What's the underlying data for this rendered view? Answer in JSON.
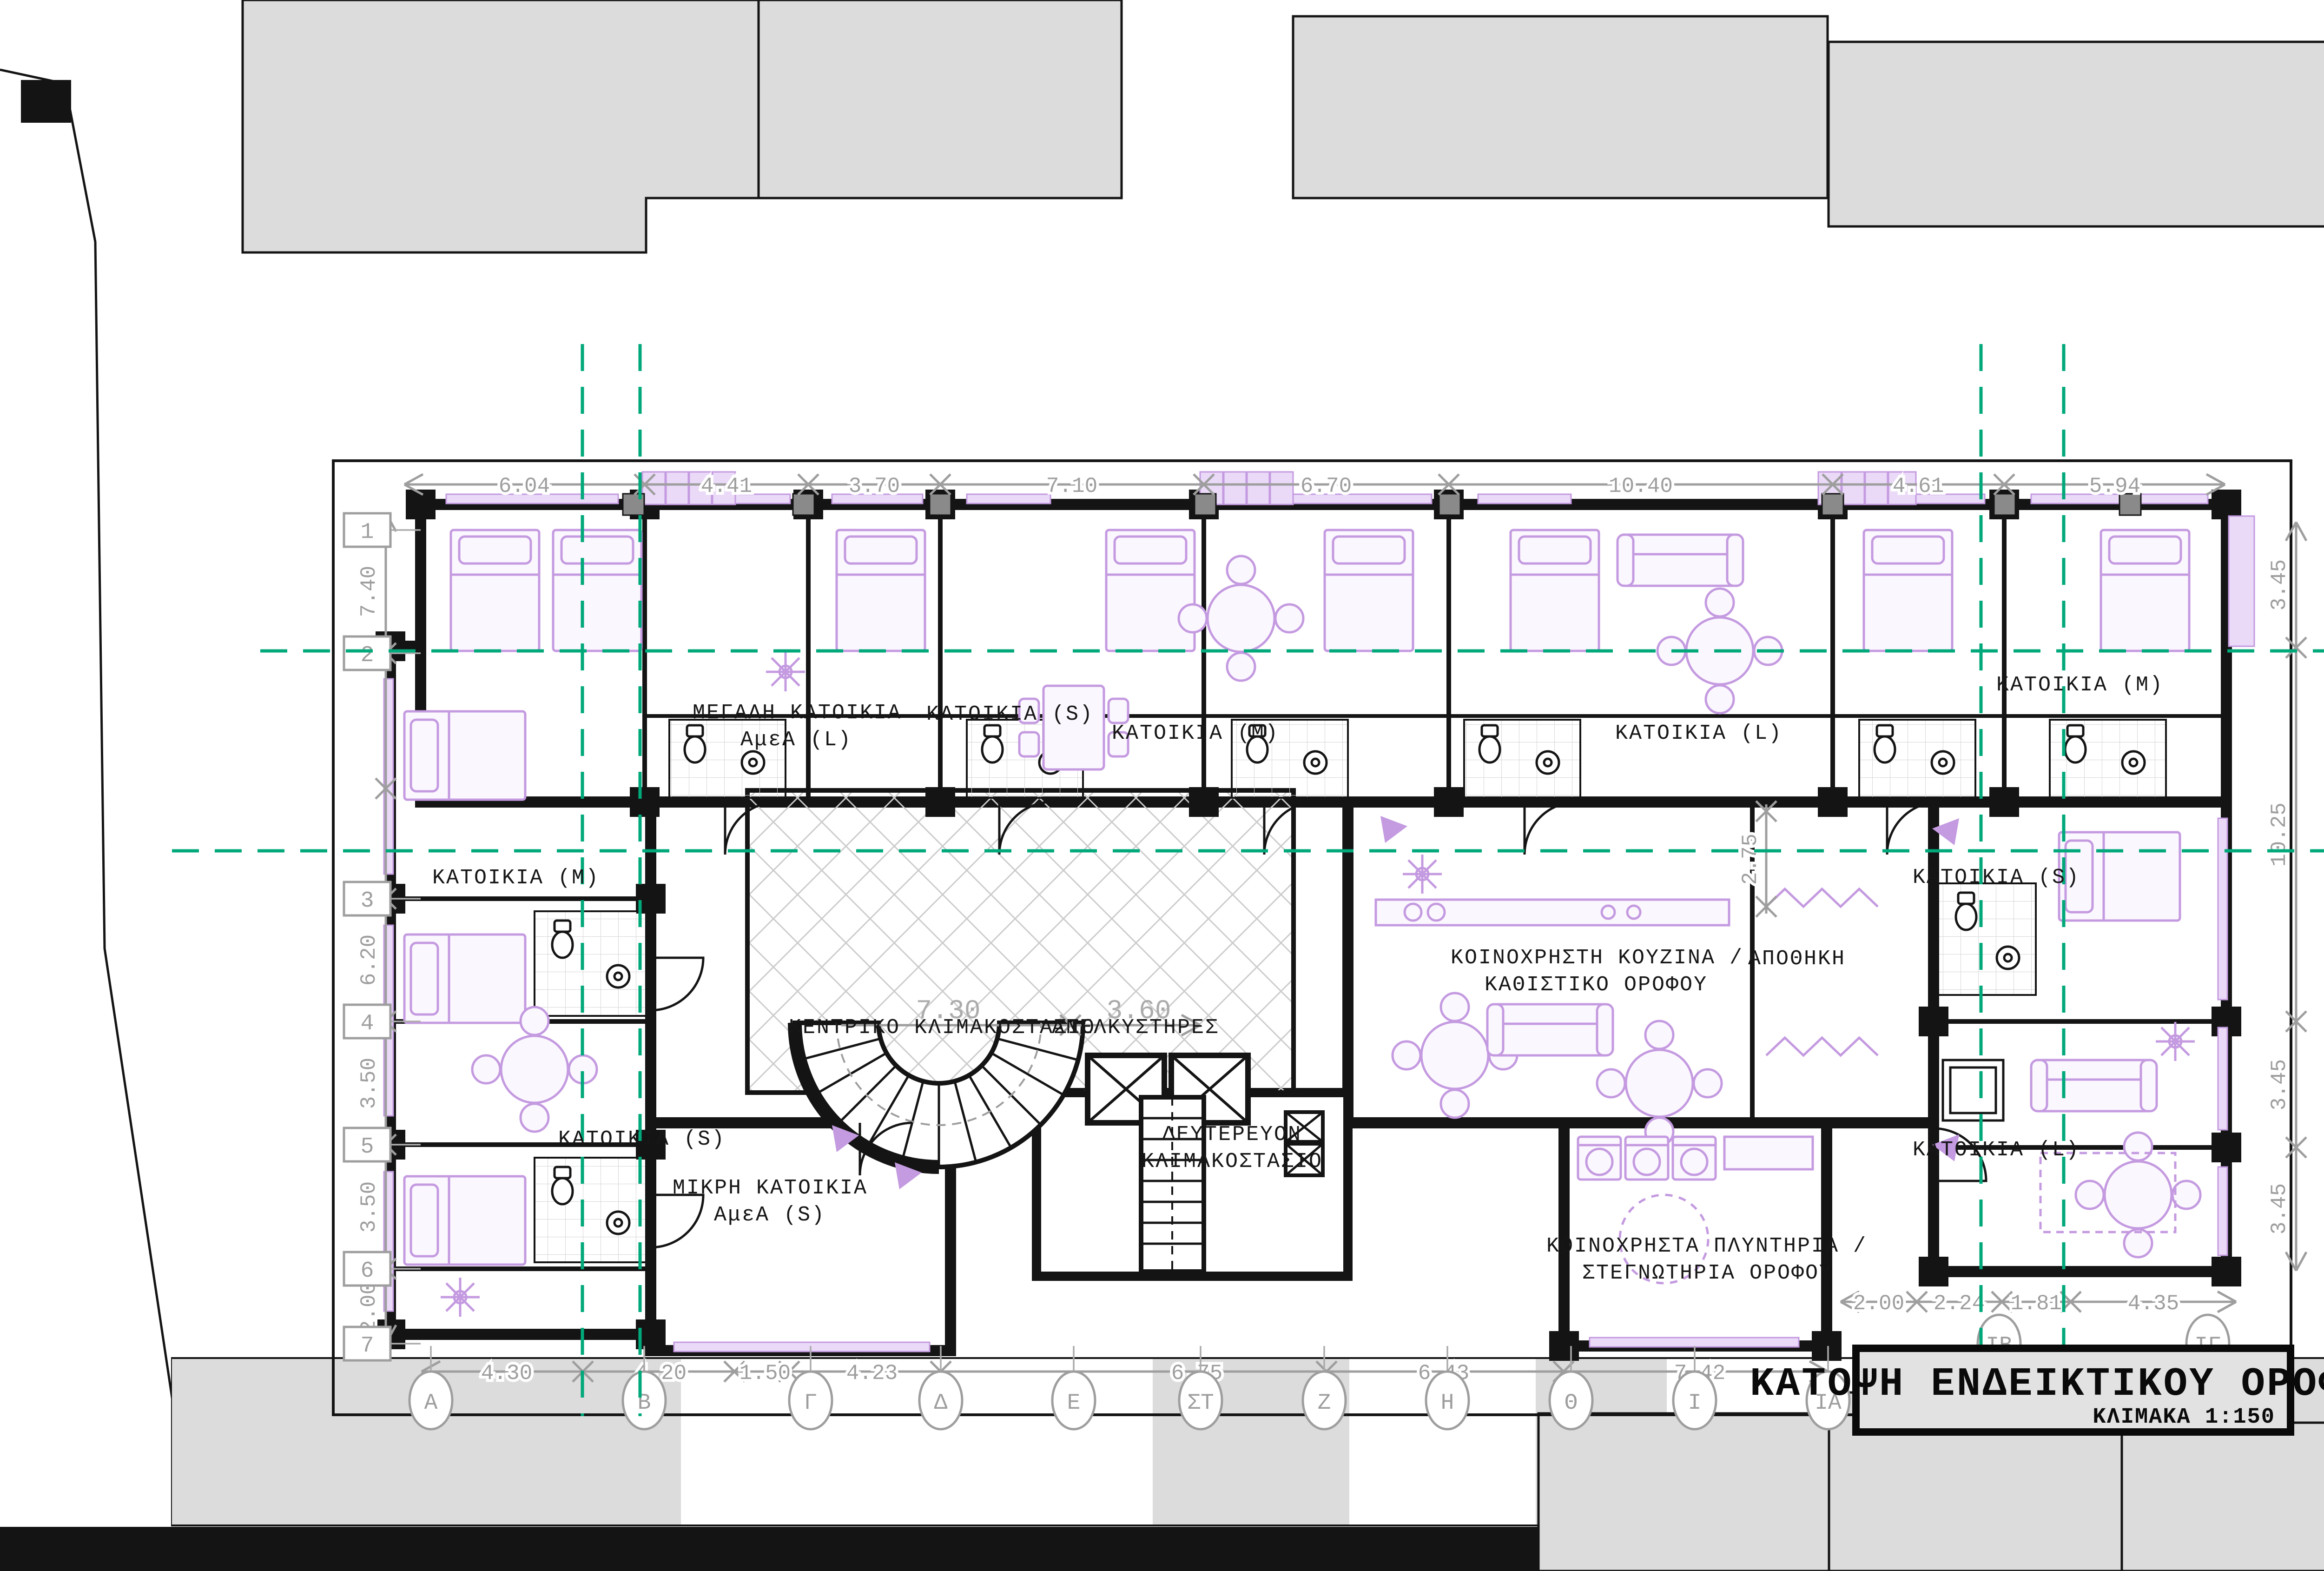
{
  "header": {
    "title": "ΚΑΤΟΨΗ ΕΝΔΕΙΚΤΙΚΟΥ ΟΡΟΦΟΥ",
    "scale": "ΚΛΙΜΑΚΑ 1:150"
  },
  "grid": {
    "rows": [
      "1",
      "2",
      "3",
      "4",
      "5",
      "6",
      "7"
    ],
    "cols": [
      "Α",
      "Β",
      "Γ",
      "Δ",
      "Ε",
      "ΣΤ",
      "Ζ",
      "Η",
      "Θ",
      "Ι",
      "ΙΑ"
    ],
    "cols_right": [
      "ΙΒ",
      "ΙΓ"
    ]
  },
  "dims": {
    "top": [
      "6.04",
      "4.41",
      "3.70",
      "7.10",
      "6.70",
      "10.40",
      "4.61",
      "5.94"
    ],
    "left": [
      "7.40",
      "6.20",
      "3.50",
      "3.50",
      "2.00"
    ],
    "right": [
      "3.45",
      "10.25",
      "3.45",
      "3.45"
    ],
    "bottom": [
      "4.30",
      "4.20",
      "1.50",
      "4.23",
      "6.75",
      "6.43",
      "7.42"
    ],
    "bottom_right": [
      "2.00",
      "2.24",
      "1.81",
      "4.35"
    ],
    "inner": [
      "7.30",
      "3.60",
      "2.75"
    ]
  },
  "rooms": {
    "large_unit_1": "ΜΕΓΑΛΗ ΚΑΤΟΙΚΙΑ",
    "large_unit_2": "ΑμεΑ (L)",
    "unit_s_top": "ΚΑΤΟΙΚΙΑ (S)",
    "unit_m_top": "ΚΑΤΟΙΚΙΑ (M)",
    "unit_l_top": "ΚΑΤΟΙΚΙΑ (L)",
    "unit_m_top_right": "ΚΑΤΟΙΚΙΑ (M)",
    "unit_m_left": "ΚΑΤΟΙΚΙΑ (M)",
    "unit_s_left": "ΚΑΤΟΙΚΙΑ (S)",
    "small_unit_1": "ΜΙΚΡΗ ΚΑΤΟΙΚΙΑ",
    "small_unit_2": "ΑμεΑ (S)",
    "unit_s_right": "ΚΑΤΟΙΚΙΑ (S)",
    "unit_l_right": "ΚΑΤΟΙΚΙΑ (L)",
    "main_stair": "ΚΕΝΤΡΙΚΟ ΚΛΙΜΑΚΟΣΤΑΣΙΟ",
    "elevators": "ΑΝΕΛΚΥΣΤΗΡΕΣ",
    "secondary_stair_1": "ΔΕΥΤΕΡΕΥΟΝ",
    "secondary_stair_2": "ΚΛΙΜΑΚΟΣΤΑΣΙΟ",
    "common_kitchen_1": "ΚΟΙΝΟΧΡΗΣΤΗ ΚΟΥΖΙΝΑ /",
    "common_kitchen_2": "ΚΑΘΙΣΤΙΚΟ ΟΡΟΦΟΥ",
    "storage": "ΑΠΟΘΗΚΗ",
    "laundry_1": "ΚΟΙΝΟΧΡΗΣΤΑ ΠΛΥΝΤΗΡΙΑ /",
    "laundry_2": "ΣΤΕΓΝΩΤΗΡΙΑ ΟΡΟΦΟΥ"
  },
  "colors": {
    "grid_line_teal": "#00A87A",
    "furniture_purple": "#C49AE0",
    "dimension_gray": "#9E9E9E",
    "wall_black": "#141414",
    "context_gray": "#DCDCDC",
    "title_block_gray": "#E2E2E2"
  }
}
